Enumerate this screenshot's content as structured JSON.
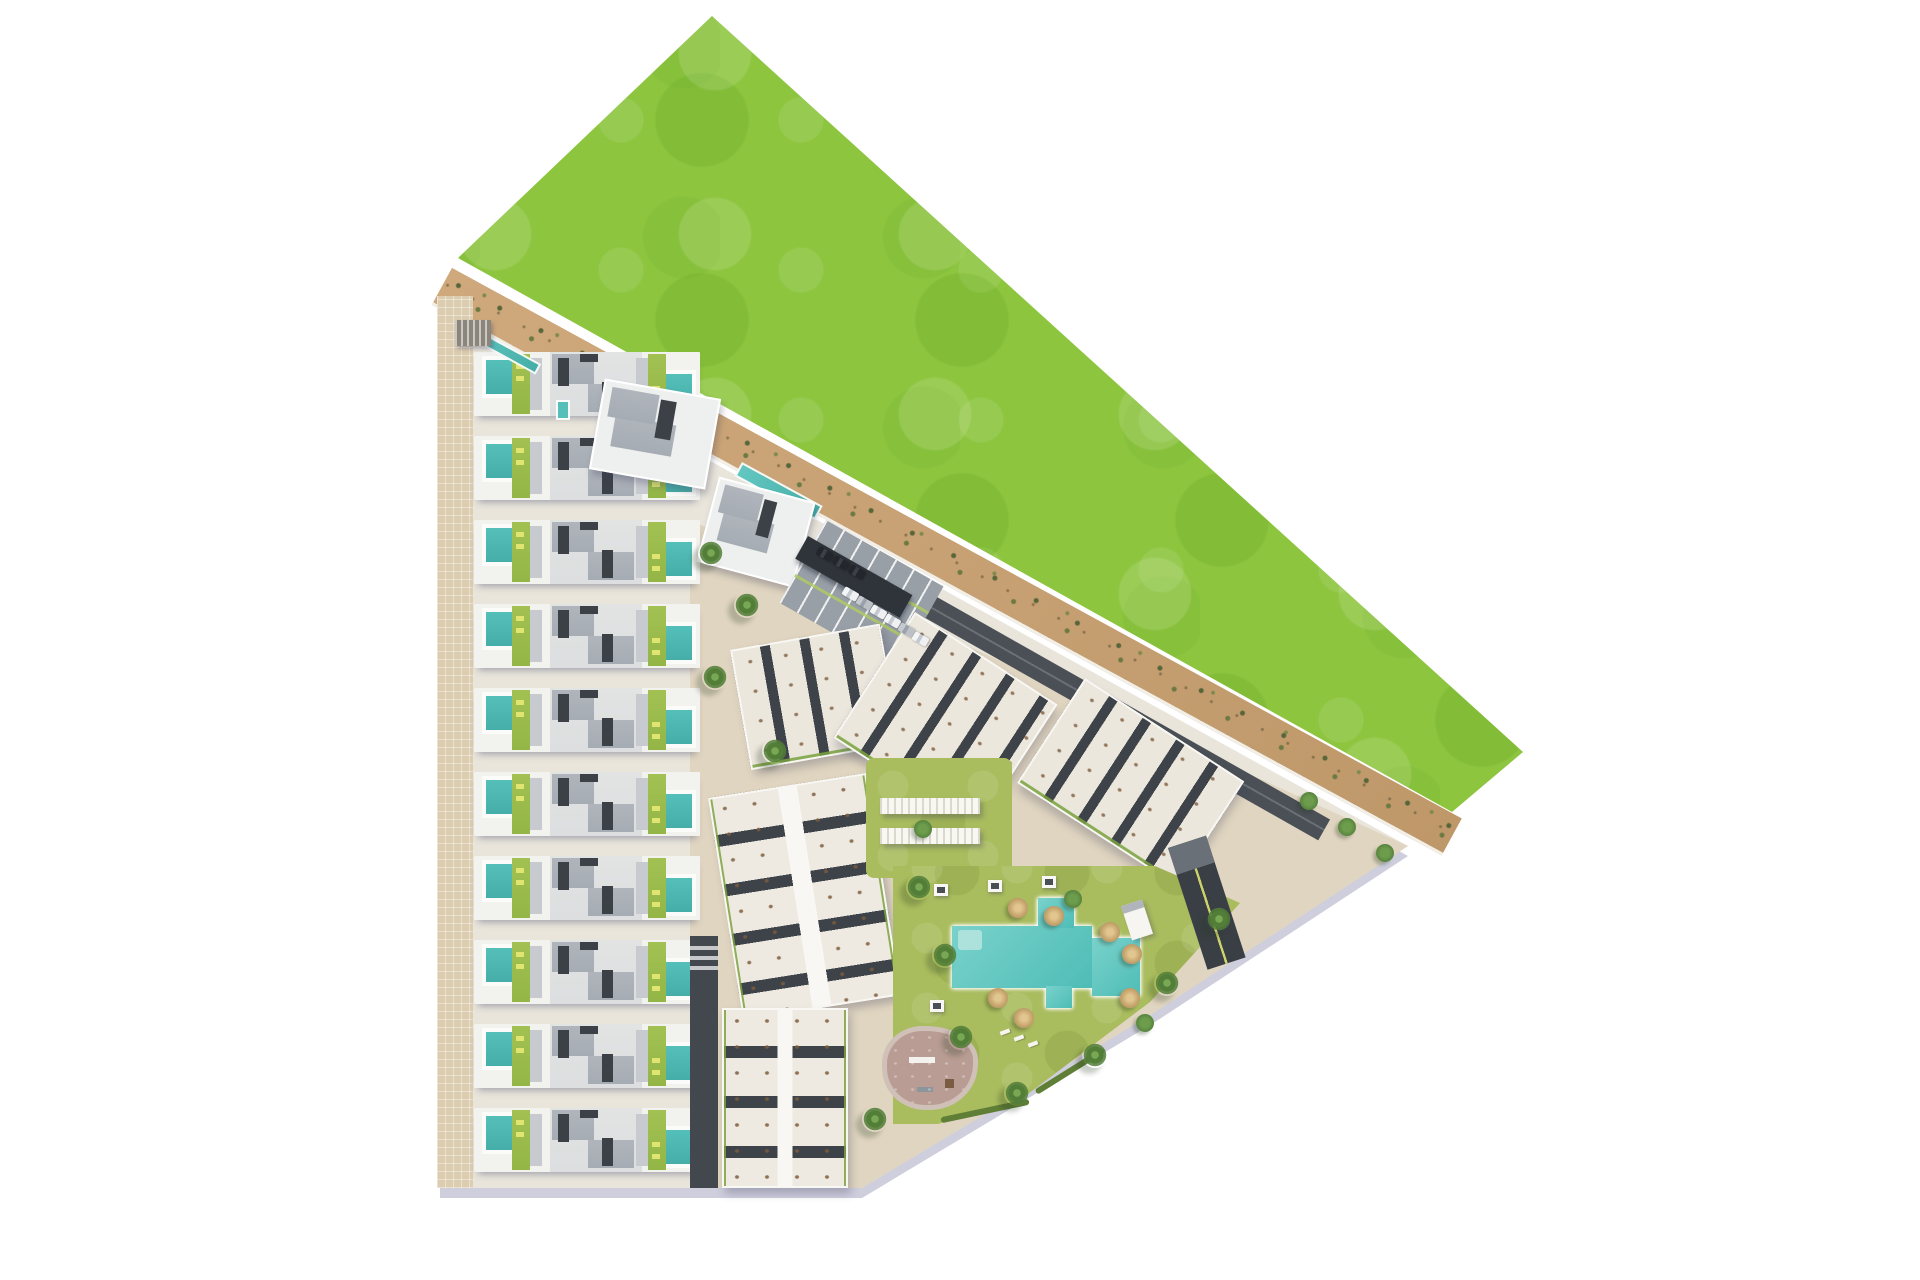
{
  "scene": {
    "kind": "aerial-site-plan-render",
    "background_color": "#ffffff"
  },
  "areas": {
    "green_field": {
      "name": "grass meadow",
      "color": "#8dc53f"
    },
    "dune_belt": {
      "name": "sand belt with scattered shrubs",
      "color": "#c8a276"
    },
    "sidewalk": {
      "name": "perimeter sidewalk",
      "color": "#dcccb0"
    },
    "plot_paving": {
      "name": "site paving",
      "color": "#e9e5db"
    },
    "central_plaza": {
      "name": "central plaza paving",
      "color": "#d8c9aa"
    },
    "townhouse_block": {
      "name": "townhouse rows",
      "row_count": 10,
      "pools_per_row": 2,
      "pool_color": "#4fb9b4",
      "lawn_strip_color": "#a2c152",
      "roof_deck_color": "#aeb3bb",
      "roof_slot_color": "#3c4148"
    },
    "north_building": {
      "name": "north residence"
    },
    "clubhouse": {
      "name": "clubhouse with lap pool",
      "lap_pool_color": "#57c0ba"
    },
    "communal_lap_pool": {
      "name": "boundary lap pool",
      "color": "#57c0ba"
    },
    "parking_lot": {
      "name": "parking lot",
      "asphalt_color": "#989fa7",
      "carport_color": "#2f343a",
      "car_colors": [
        "dark",
        "dark",
        "dark",
        "white",
        "silver",
        "white",
        "white",
        "silver",
        "white"
      ]
    },
    "access_road": {
      "name": "access road along dune",
      "color": "#4a5056"
    },
    "south_road": {
      "name": "internal south road",
      "color": "#43484f"
    },
    "apartment_clusters": {
      "name": "tilted apartment clusters",
      "count": 3,
      "roof_color": "#ece7dd",
      "band_color": "#3e434a",
      "hedge_color": "#7ba23f"
    },
    "garden_blocks": {
      "name": "south apartment blocks",
      "count": 2
    },
    "pergola_garden": {
      "name": "pergola sun deck",
      "pergola_count": 2,
      "lawn_color": "#a9bc5e"
    },
    "pool_garden": {
      "name": "communal pool garden",
      "pool_color": "#62c8c2",
      "lawn_color": "#a9bc5e",
      "umbrella_count": 7,
      "cabana_count": 4,
      "lounger_count": 3,
      "palm_count": 12,
      "tree_count": 6
    },
    "playground": {
      "name": "children playground",
      "surface_color": "#b99c93"
    },
    "garage_ramp": {
      "name": "garage ramp",
      "color": "#3a3f45"
    }
  }
}
